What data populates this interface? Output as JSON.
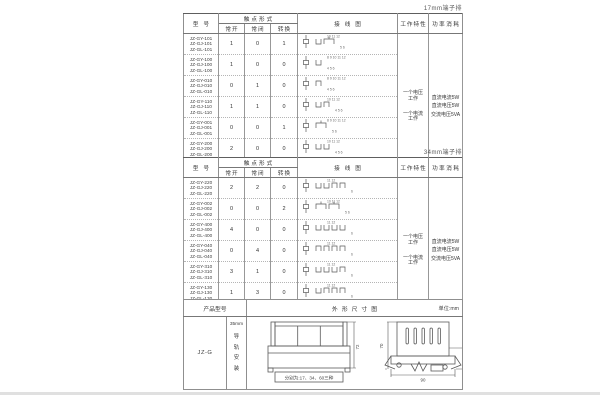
{
  "labels": {
    "corner17": "17mm端子排",
    "corner34": "34mm端子排"
  },
  "headers": {
    "model": "型号",
    "contact_form": "触点形式",
    "no": "常开",
    "nc": "常闭",
    "co": "转换",
    "wiring": "接线图",
    "working": "工作特性",
    "power": "功率消耗"
  },
  "working_items": [
    "一个电压工作",
    "一个电流工作"
  ],
  "power_items": [
    "直流电流5W",
    "直流电压5W",
    "交流电压5VA"
  ],
  "table17": {
    "rows": [
      {
        "models": [
          "JZ-GY-101",
          "JZ-GJ-101",
          "JZ-GL-101"
        ],
        "no": "1",
        "nc": "0",
        "co": "1",
        "top": "10 11 12",
        "bottom": "5 6"
      },
      {
        "models": [
          "JZ-GY-100",
          "JZ-GJ-100",
          "JZ-GL-100"
        ],
        "no": "1",
        "nc": "0",
        "co": "0",
        "top": "8 9 10 11 12",
        "bottom": "4 5 6"
      },
      {
        "models": [
          "JZ-GY-010",
          "JZ-GJ-010",
          "JZ-GL-010"
        ],
        "no": "0",
        "nc": "1",
        "co": "0",
        "top": "8 9 10 11 12",
        "bottom": "4 5 6"
      },
      {
        "models": [
          "JZ-GY-110",
          "JZ-GJ-110",
          "JZ-GL-110"
        ],
        "no": "1",
        "nc": "1",
        "co": "0",
        "top": "10 11 12",
        "bottom": "4 5 6"
      },
      {
        "models": [
          "JZ-GY-001",
          "JZ-GJ-001",
          "JZ-GL-001"
        ],
        "no": "0",
        "nc": "0",
        "co": "1",
        "top": "8 9 10 11 12",
        "bottom": "5 6"
      },
      {
        "models": [
          "JZ-GY-200",
          "JZ-GJ-200",
          "JZ-GL-200"
        ],
        "no": "2",
        "nc": "0",
        "co": "0",
        "top": "10 11 12",
        "bottom": "4 5 6"
      },
      {
        "models": [
          "JZ-GY-011",
          "JZ-GJ-011",
          "JZ-GL-011"
        ],
        "no": "0",
        "nc": "1",
        "co": "1",
        "top": "8 9 10 11 12",
        "bottom": "4 5 6"
      }
    ]
  },
  "table34": {
    "rows": [
      {
        "models": [
          "JZ-GY-220",
          "JZ-GJ-220",
          "JZ-GL-220"
        ],
        "no": "2",
        "nc": "2",
        "co": "0",
        "top": "11 12",
        "bottom": "6"
      },
      {
        "models": [
          "JZ-GY-002",
          "JZ-GJ-002",
          "JZ-GL-002"
        ],
        "no": "0",
        "nc": "0",
        "co": "2",
        "top": "10 11 12",
        "bottom": "5 6"
      },
      {
        "models": [
          "JZ-GY-400",
          "JZ-GJ-400",
          "JZ-GL-400"
        ],
        "no": "4",
        "nc": "0",
        "co": "0",
        "top": "11 12",
        "bottom": "6"
      },
      {
        "models": [
          "JZ-GY-040",
          "JZ-GJ-040",
          "JZ-GL-040"
        ],
        "no": "0",
        "nc": "4",
        "co": "0",
        "top": "11 12",
        "bottom": "6"
      },
      {
        "models": [
          "JZ-GY-310",
          "JZ-GJ-310",
          "JZ-GL-310"
        ],
        "no": "3",
        "nc": "1",
        "co": "0",
        "top": "11 12",
        "bottom": "6"
      },
      {
        "models": [
          "JZ-GY-130",
          "JZ-GJ-130",
          "JZ-GL-130"
        ],
        "no": "1",
        "nc": "3",
        "co": "0",
        "top": "11 12",
        "bottom": "6"
      },
      {
        "models": [
          "JZ-GY-112",
          "JZ-GJ-112",
          "JZ-GL-112"
        ],
        "no": "1",
        "nc": "1",
        "co": "2",
        "top": "11 12",
        "bottom": "6"
      }
    ]
  },
  "bottom": {
    "header_product": "产品型号",
    "header_outline": "外形尺寸图",
    "unit": "单位:mm",
    "model": "JZ-G",
    "mount_top": "35mm",
    "mount_chars": "导轨安装",
    "front_note": "分别为:17、34、60三种",
    "dim_front_height": "72",
    "dim_side_height": "70",
    "dim_side_right": "35",
    "dim_side_width": "90"
  }
}
